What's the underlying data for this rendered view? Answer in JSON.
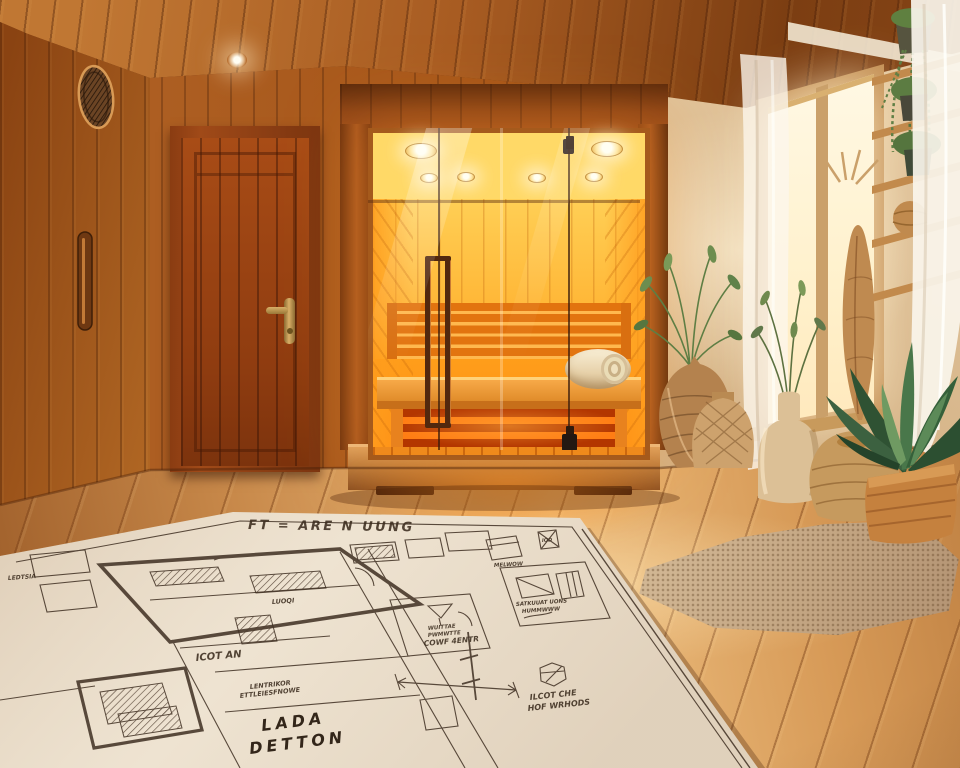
{
  "scene": {
    "colors": {
      "ceiling_wood": "#a35a20",
      "wall_wood": "#b06226",
      "door_wood": "#993f12",
      "sauna_glow": "#ffa51e",
      "heater_glow": "#ff6a00",
      "right_wall": "#d8b890",
      "window_light": "#fff4d8",
      "floor_wood": "#d79a57",
      "rug": "#c7ab88",
      "plant_green": "#4f7a4e",
      "wicker": "#c0905a",
      "blueprint_paper": "#ece0cd",
      "blueprint_ink": "#3f2f22"
    }
  },
  "blueprint": {
    "title": "FT = ARE N UUNG",
    "labels": {
      "tiny_left": "LEDTSIA",
      "bed_tag": "LUOQI",
      "room_tag": "ICOT AN",
      "note_line1": "LENTRIKOR",
      "note_line2": "ETTLEIESFNOWE",
      "big_line1": "LADA",
      "big_line2": "DETTON",
      "cone_line1": "WUITTAE",
      "cone_line2": "PWMWTTE",
      "cone_line3": "COWF 4ENTR",
      "hex_line1": "ILCOT CHE",
      "hex_line2": "HOF WRHODS",
      "bed_note1": "SATKUUAT UONS",
      "bed_note2": "HUMMWWW",
      "tiny_top": "MELWOW",
      "tiny_corner": "IOD"
    }
  }
}
